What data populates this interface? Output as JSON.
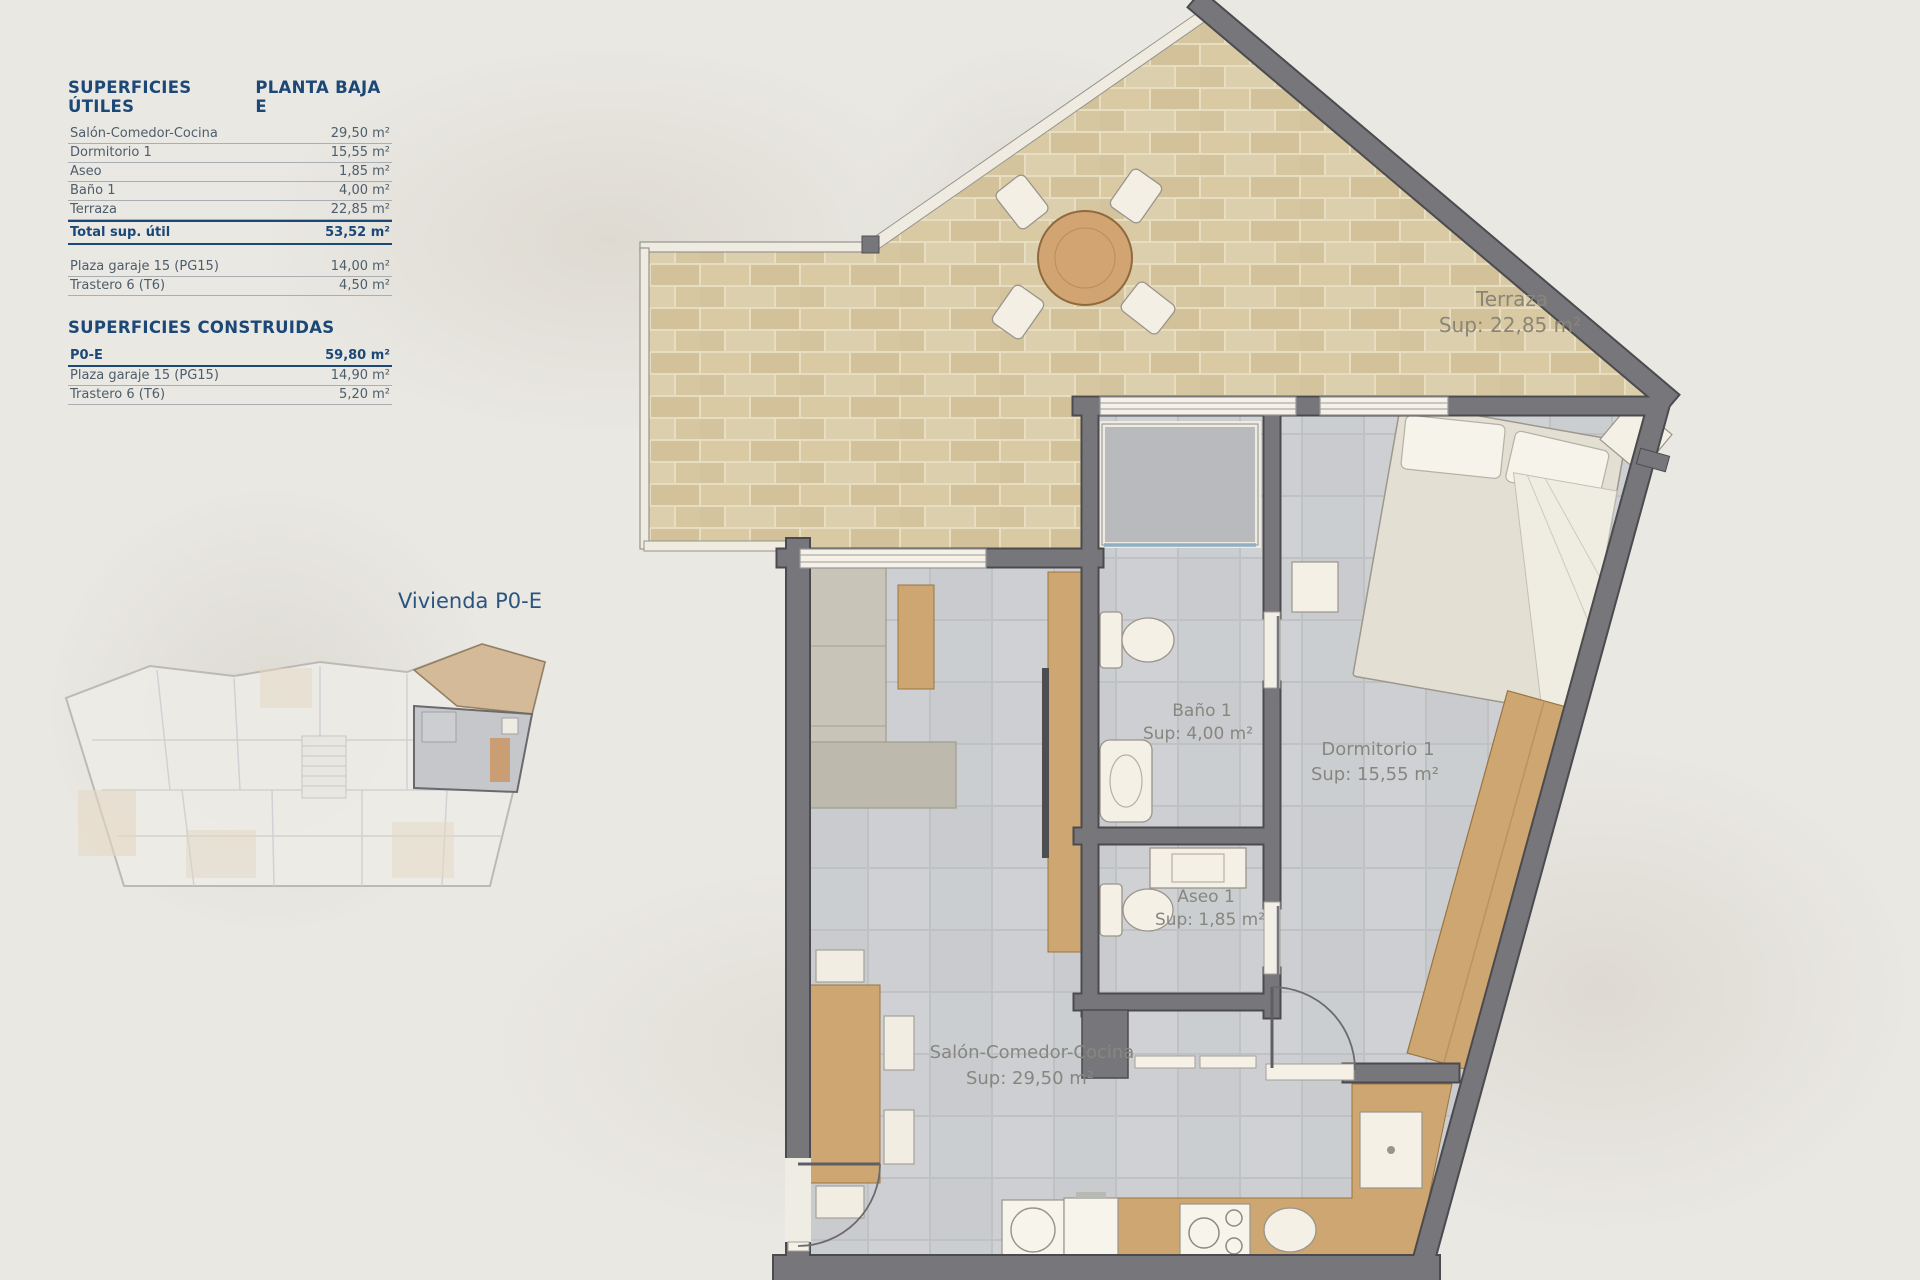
{
  "legend": {
    "title": "SUPERFICIES ÚTILES",
    "plan_title": "PLANTA BAJA E",
    "rows": [
      {
        "label": "Salón-Comedor-Cocina",
        "value": "29,50 m²"
      },
      {
        "label": "Dormitorio 1",
        "value": "15,55 m²"
      },
      {
        "label": "Aseo",
        "value": "1,85 m²"
      },
      {
        "label": "Baño 1",
        "value": "4,00 m²"
      },
      {
        "label": "Terraza",
        "value": "22,85 m²"
      }
    ],
    "total": {
      "label": "Total sup. útil",
      "value": "53,52 m²"
    },
    "annex_rows": [
      {
        "label": "Plaza garaje 15 (PG15)",
        "value": "14,00 m²"
      },
      {
        "label": "Trastero 6 (T6)",
        "value": "4,50 m²"
      }
    ],
    "built_title": "SUPERFICIES CONSTRUIDAS",
    "built_rows": [
      {
        "label": "P0-E",
        "value": "59,80 m²"
      },
      {
        "label": "Plaza garaje 15 (PG15)",
        "value": "14,90 m²"
      },
      {
        "label": "Trastero 6 (T6)",
        "value": "5,20 m²"
      }
    ]
  },
  "overview": {
    "caption": "Vivienda P0-E"
  },
  "plan": {
    "rooms": {
      "terraza": {
        "name": "Terraza",
        "sup": "Sup: 22,85 m²"
      },
      "bano": {
        "name": "Baño 1",
        "sup": "Sup: 4,00 m²"
      },
      "dormitorio": {
        "name": "Dormitorio 1",
        "sup": "Sup: 15,55 m²"
      },
      "aseo": {
        "name": "Aseo 1",
        "sup": "Sup: 1,85 m²"
      },
      "salon": {
        "name": "Salón-Comedor-Cocina",
        "sup": "Sup: 29,50 m²"
      }
    },
    "colors": {
      "accent_blue": "#1c4877",
      "wall_gray": "#77777b",
      "terrace_tile": "#d9caa4",
      "interior_tile": "#cdcfd2",
      "wood": "#cda671"
    }
  }
}
